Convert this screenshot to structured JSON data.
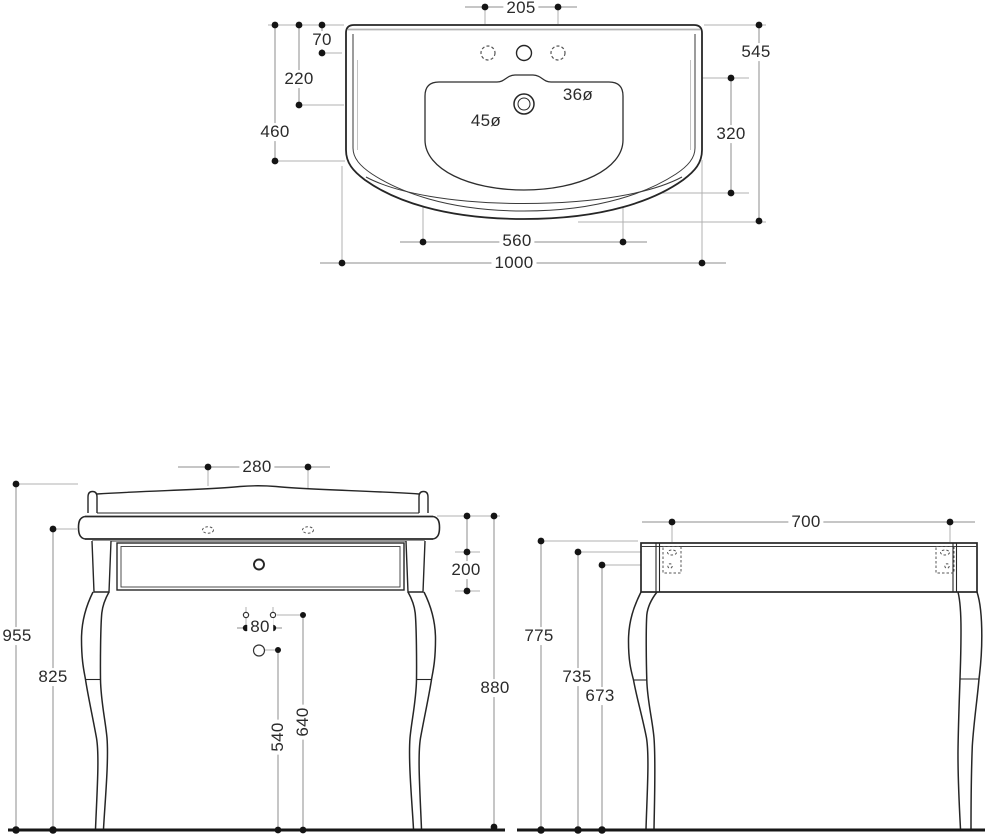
{
  "colors": {
    "outline": "#262626",
    "dim_line": "#8e8e8e",
    "ext_line": "#b0b0b0",
    "text": "#2b2b2b",
    "background": "#ffffff"
  },
  "views": {
    "washbasin_top": {
      "label": "washbasin-top-view",
      "dims": {
        "faucet_hole_spacing": "205",
        "rim_to_faucet_holes": "70",
        "rim_to_drain_center": "220",
        "side_depth": "460",
        "overall_depth": "545",
        "bowl_depth": "320",
        "faucet_hole_diameter": "36ø",
        "drain_hole_diameter": "45ø",
        "bowl_width": "560",
        "overall_width": "1000"
      }
    },
    "console_front": {
      "label": "console-front-view",
      "dims": {
        "slot_spacing": "280",
        "overall_height": "955",
        "underside_height": "825",
        "apron_height": "200",
        "worktop_height": "880",
        "fixing_hole_spacing": "80",
        "siphon_hole_height": "540",
        "fixing_holes_height": "640"
      }
    },
    "console_side": {
      "label": "console-side-view",
      "dims": {
        "top_depth": "700",
        "front_height": "775",
        "bracket_slot_height": "735",
        "bracket_screw_height": "673"
      }
    }
  }
}
